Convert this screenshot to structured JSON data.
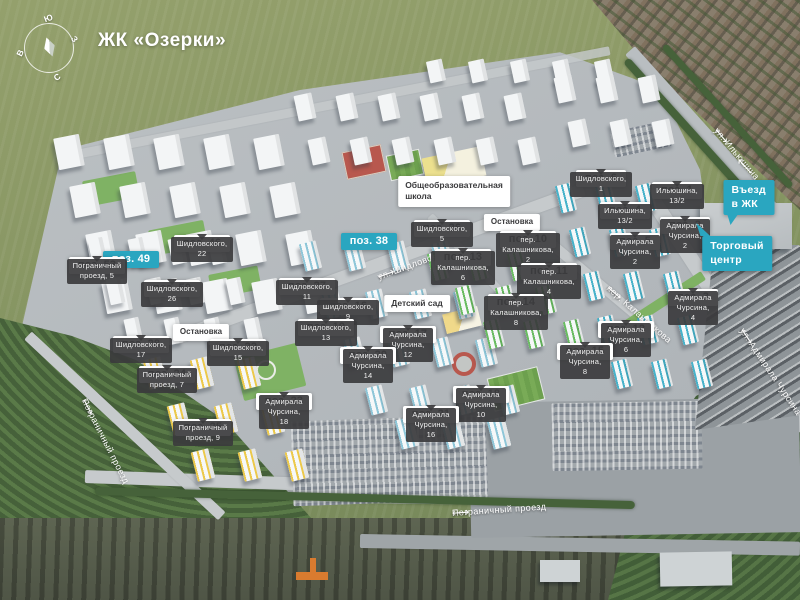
{
  "title": "ЖК «Озерки»",
  "compass": {
    "top": "Ю",
    "right": "З",
    "bottom": "С",
    "left": "В"
  },
  "colors": {
    "teal": "#2aa6c0",
    "label_dark": "#3b3b3d",
    "label_white": "#ffffff"
  },
  "position_labels": [
    {
      "num": "поз. 1",
      "address": "Ильюшина, 13/2",
      "x": 677,
      "y": 182,
      "hl": false
    },
    {
      "num": "поз. 2",
      "address": "Адмирала\nЧурсина, 2",
      "x": 685,
      "y": 217,
      "hl": false
    },
    {
      "num": "поз. 3",
      "address": "Адмирала\nЧурсина, 4",
      "x": 693,
      "y": 289,
      "hl": false
    },
    {
      "num": "поз. 4",
      "address": "Ильюшина, 13/2",
      "x": 625,
      "y": 202,
      "hl": false
    },
    {
      "num": "поз. 5",
      "address": "Адмирала\nЧурсина, 2",
      "x": 635,
      "y": 233,
      "hl": false
    },
    {
      "num": "поз. 6",
      "address": "Шидловского, 1",
      "x": 601,
      "y": 170,
      "hl": false
    },
    {
      "num": "поз. 10",
      "address": "пер.\nКалашникова, 2",
      "x": 528,
      "y": 231,
      "hl": false
    },
    {
      "num": "поз. 11",
      "address": "пер.\nКалашникова, 4",
      "x": 549,
      "y": 263,
      "hl": false
    },
    {
      "num": "поз. 12",
      "address": "Адмирала\nЧурсина, 6",
      "x": 626,
      "y": 321,
      "hl": false
    },
    {
      "num": "поз. 13",
      "address": "пер.\nКалашникова, 6",
      "x": 463,
      "y": 249,
      "hl": false
    },
    {
      "num": "поз. 14",
      "address": "пер.\nКалашникова, 8",
      "x": 516,
      "y": 294,
      "hl": false
    },
    {
      "num": "поз. 15",
      "address": "Адмирала\nЧурсина, 8",
      "x": 585,
      "y": 343,
      "hl": false
    },
    {
      "num": "поз. 16",
      "address": "Шидловского, 9",
      "x": 348,
      "y": 298,
      "hl": false
    },
    {
      "num": "поз. 17",
      "address": "Адмирала\nЧурсина, 12",
      "x": 408,
      "y": 326,
      "hl": false
    },
    {
      "num": "поз. 18",
      "address": "Адмирала\nЧурсина, 10",
      "x": 481,
      "y": 386,
      "hl": false
    },
    {
      "num": "поз. 19",
      "address": "Шидловского, 13",
      "x": 326,
      "y": 319,
      "hl": false
    },
    {
      "num": "поз. 20",
      "address": "Адмирала\nЧурсина, 14",
      "x": 368,
      "y": 347,
      "hl": false
    },
    {
      "num": "поз. 21",
      "address": "Адмирала\nЧурсина, 16",
      "x": 431,
      "y": 406,
      "hl": false
    },
    {
      "num": "поз. 22",
      "address": "Шидловского, 15",
      "x": 238,
      "y": 339,
      "hl": false
    },
    {
      "num": "поз. 23",
      "address": "Адмирала\nЧурсина, 18",
      "x": 284,
      "y": 393,
      "hl": false
    },
    {
      "num": "поз. 24",
      "address": "Пограничный\nпроезд, 7",
      "x": 167,
      "y": 366,
      "hl": false
    },
    {
      "num": "поз. 25",
      "address": "Пограничный\nпроезд, 9",
      "x": 203,
      "y": 419,
      "hl": false
    },
    {
      "num": "поз. 26",
      "address": "Шидловского, 5",
      "x": 442,
      "y": 220,
      "hl": false
    },
    {
      "num": "поз. 27",
      "address": "Шидловского, 11",
      "x": 307,
      "y": 278,
      "hl": false
    },
    {
      "num": "поз. 28",
      "address": "Шидловского, 17",
      "x": 141,
      "y": 336,
      "hl": false
    },
    {
      "num": "поз. 38",
      "address": "",
      "x": 369,
      "y": 233,
      "hl": true
    },
    {
      "num": "поз. 46",
      "address": "Шидловского, 22",
      "x": 202,
      "y": 235,
      "hl": false
    },
    {
      "num": "поз. 49",
      "address": "",
      "x": 131,
      "y": 251,
      "hl": true
    },
    {
      "num": "поз. 50",
      "address": "Шидловского, 26",
      "x": 172,
      "y": 280,
      "hl": false
    },
    {
      "num": "поз. 53",
      "address": "Пограничный\nпроезд, 5",
      "x": 97,
      "y": 257,
      "hl": false
    }
  ],
  "info_labels": [
    {
      "text": "Общеобразовательная\nшкола",
      "x": 454,
      "y": 176,
      "fs": 8.5,
      "pad": "4px 7px",
      "align": "left"
    },
    {
      "text": "Остановка",
      "x": 512,
      "y": 214,
      "fs": 8,
      "pad": "3px 7px",
      "align": "center"
    },
    {
      "text": "Остановка",
      "x": 201,
      "y": 324,
      "fs": 8,
      "pad": "3px 7px",
      "align": "center"
    },
    {
      "text": "Детский сад",
      "x": 417,
      "y": 295,
      "fs": 8.5,
      "pad": "3px 7px",
      "align": "center"
    }
  ],
  "promo_labels": [
    {
      "text": "Въезд в ЖК",
      "x": 749,
      "y": 180,
      "tail": "bl"
    },
    {
      "text": "Торговый\nцентр",
      "x": 737,
      "y": 236,
      "tail": "tl"
    }
  ],
  "street_labels": [
    {
      "text": "ул. Ильюшина",
      "x": 716,
      "y": 129,
      "angle": 50
    },
    {
      "text": "ул. Шидловского",
      "x": 378,
      "y": 277,
      "angle": -20
    },
    {
      "text": "пер. Калашникова",
      "x": 608,
      "y": 287,
      "angle": 41
    },
    {
      "text": "ул. Адмирала Чурсина",
      "x": 742,
      "y": 329,
      "angle": 56
    },
    {
      "text": "Пограничный проезд",
      "x": 452,
      "y": 513,
      "angle": -4
    },
    {
      "text": "Пограничный проезд",
      "x": 84,
      "y": 399,
      "angle": 63
    }
  ],
  "arrows": {
    "left": "⟵",
    "right": "⟶",
    "entry": "⟶"
  }
}
